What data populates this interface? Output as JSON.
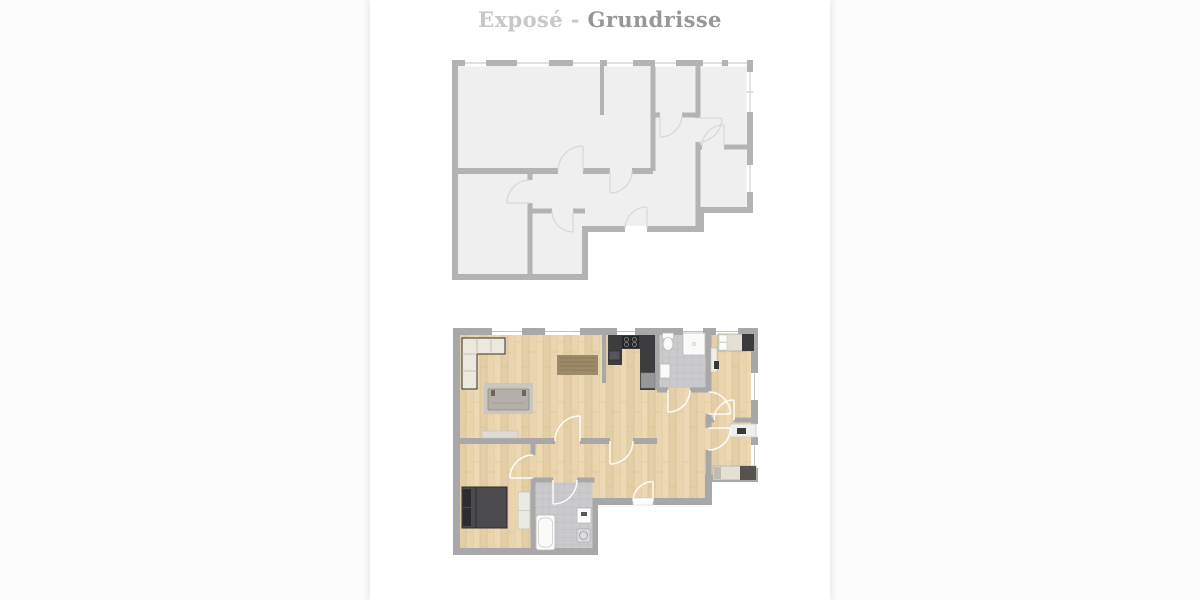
{
  "header": {
    "title_light": "Exposé",
    "title_separator": "-",
    "title_dark": "Grundrisse"
  },
  "plans": [
    {
      "id": "schematic",
      "kind": "outline-floorplan"
    },
    {
      "id": "furnished",
      "kind": "furnished-floorplan"
    }
  ],
  "colors": {
    "page_bg": "#fcfcfc",
    "panel_bg": "#ffffff",
    "title_light": "#c7c7c7",
    "title_dark": "#979797",
    "plan1_wall": "#b3b3b3",
    "plan1_floor": "#efefef",
    "plan1_door": "#d9d9d9",
    "plan2_wall": "#a8a8a8",
    "wood_base": "#e9d5af",
    "wood_grain": "#d6bd93",
    "tile": "#cacacd",
    "tile_line": "#b9b9bd",
    "counter_dark": "#3d3d3f",
    "bed_dark": "#4a4a4f",
    "rug_gray": "#cac7c1",
    "rug_brown": "#9d8a6b",
    "window_line": "#c2c2c2"
  }
}
